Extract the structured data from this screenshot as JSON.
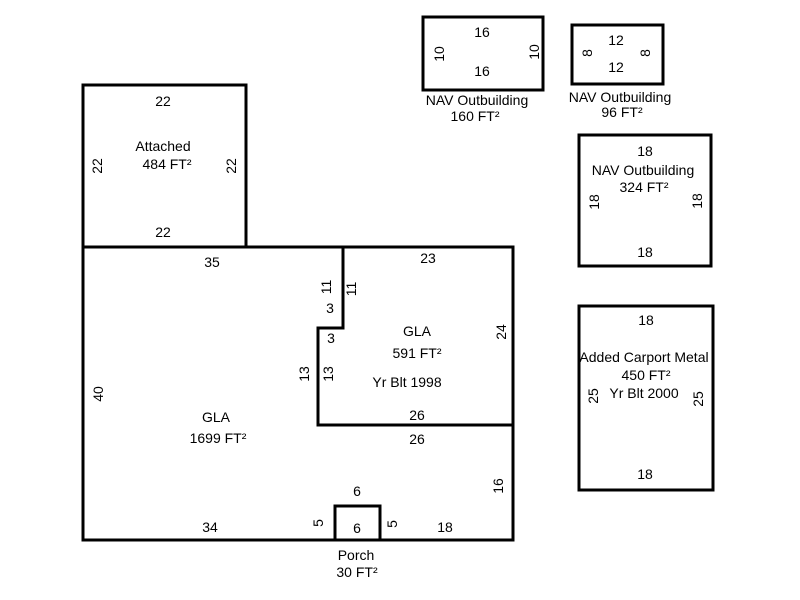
{
  "diagram": {
    "kind": "property-appraisal-sketch",
    "background": "#ffffff",
    "stroke": "#000000",
    "stroke_width": 3,
    "font_size_px": 14
  },
  "structures": [
    {
      "id": "attached-garage",
      "name": "Attached",
      "area": "484 FT²",
      "shapes": [
        {
          "name": "attached-garage-outline",
          "type": "rect",
          "x": 83,
          "y": 85,
          "w": 163,
          "h": 162
        }
      ],
      "labels": [
        {
          "role": "dim-top",
          "text": "22",
          "x": 163,
          "y": 101,
          "rot": 0
        },
        {
          "role": "name",
          "text": "Attached",
          "x": 163,
          "y": 146,
          "rot": 0
        },
        {
          "role": "area",
          "text": "484 FT²",
          "x": 167,
          "y": 164,
          "rot": 0
        },
        {
          "role": "dim-left",
          "text": "22",
          "x": 97,
          "y": 166,
          "rot": 1
        },
        {
          "role": "dim-right",
          "text": "22",
          "x": 231,
          "y": 166,
          "rot": 1
        },
        {
          "role": "dim-bottom",
          "text": "22",
          "x": 163,
          "y": 232,
          "rot": 0
        }
      ]
    },
    {
      "id": "main-dwelling",
      "name": "GLA",
      "area": "1699 FT²",
      "shapes": [
        {
          "name": "main-dwelling-outline",
          "type": "rect",
          "x": 83,
          "y": 247,
          "w": 430,
          "h": 293
        },
        {
          "name": "gla2-partition-wall",
          "type": "polyline",
          "points": [
            [
              343,
              247
            ],
            [
              343,
              328
            ],
            [
              318,
              328
            ],
            [
              318,
              425
            ],
            [
              513,
              425
            ]
          ]
        },
        {
          "name": "porch-outline",
          "type": "polyline",
          "points": [
            [
              335,
              540
            ],
            [
              335,
              506
            ],
            [
              380,
              506
            ],
            [
              380,
              540
            ]
          ]
        }
      ],
      "labels": [
        {
          "role": "dim-top-left",
          "text": "35",
          "x": 212,
          "y": 262,
          "rot": 0
        },
        {
          "role": "dim-top-right",
          "text": "23",
          "x": 428,
          "y": 258,
          "rot": 0
        },
        {
          "role": "dim-left",
          "text": "40",
          "x": 98,
          "y": 394,
          "rot": 1
        },
        {
          "role": "gla-name",
          "text": "GLA",
          "x": 216,
          "y": 417,
          "rot": 0
        },
        {
          "role": "gla-area",
          "text": "1699 FT²",
          "x": 218,
          "y": 438,
          "rot": 0
        },
        {
          "role": "partition-dim-11-outer",
          "text": "11",
          "x": 326,
          "y": 287,
          "rot": 1
        },
        {
          "role": "partition-dim-11-inner",
          "text": "11",
          "x": 351,
          "y": 289,
          "rot": 1
        },
        {
          "role": "partition-dim-3-upper",
          "text": "3",
          "x": 330,
          "y": 308,
          "rot": 0
        },
        {
          "role": "partition-dim-3-lower",
          "text": "3",
          "x": 331,
          "y": 338,
          "rot": 0
        },
        {
          "role": "partition-dim-13-outer",
          "text": "13",
          "x": 304,
          "y": 374,
          "rot": 1
        },
        {
          "role": "partition-dim-13-inner",
          "text": "13",
          "x": 328,
          "y": 374,
          "rot": 1
        },
        {
          "role": "gla2-name",
          "text": "GLA",
          "x": 417,
          "y": 331,
          "rot": 0
        },
        {
          "role": "gla2-area",
          "text": "591 FT²",
          "x": 417,
          "y": 353,
          "rot": 0
        },
        {
          "role": "gla2-year",
          "text": "Yr Blt 1998",
          "x": 407,
          "y": 382,
          "rot": 0
        },
        {
          "role": "dim-right-upper",
          "text": "24",
          "x": 501,
          "y": 332,
          "rot": 1
        },
        {
          "role": "partition-dim-26-inner",
          "text": "26",
          "x": 417,
          "y": 415,
          "rot": 0
        },
        {
          "role": "partition-dim-26-outer",
          "text": "26",
          "x": 417,
          "y": 439,
          "rot": 0
        },
        {
          "role": "dim-right-lower",
          "text": "16",
          "x": 498,
          "y": 486,
          "rot": 1
        },
        {
          "role": "dim-bottom-left",
          "text": "34",
          "x": 210,
          "y": 527,
          "rot": 0
        },
        {
          "role": "porch-dim-left",
          "text": "5",
          "x": 318,
          "y": 523,
          "rot": 1
        },
        {
          "role": "porch-dim-top",
          "text": "6",
          "x": 357,
          "y": 491,
          "rot": 0
        },
        {
          "role": "porch-dim-inner",
          "text": "6",
          "x": 357,
          "y": 528,
          "rot": 0
        },
        {
          "role": "porch-dim-right",
          "text": "5",
          "x": 392,
          "y": 524,
          "rot": 1
        },
        {
          "role": "dim-bottom-right",
          "text": "18",
          "x": 445,
          "y": 527,
          "rot": 0
        },
        {
          "role": "porch-name",
          "text": "Porch",
          "x": 356,
          "y": 555,
          "rot": 0
        },
        {
          "role": "porch-area",
          "text": "30 FT²",
          "x": 357,
          "y": 572,
          "rot": 0
        }
      ]
    },
    {
      "id": "nav-outbuilding-160",
      "name": "NAV Outbuilding",
      "area": "160 FT²",
      "shapes": [
        {
          "name": "nav-outbuilding-160-outline",
          "type": "rect",
          "x": 423,
          "y": 17,
          "w": 120,
          "h": 73
        }
      ],
      "labels": [
        {
          "role": "dim-top",
          "text": "16",
          "x": 482,
          "y": 32,
          "rot": 0
        },
        {
          "role": "dim-left",
          "text": "10",
          "x": 439,
          "y": 54,
          "rot": 1
        },
        {
          "role": "dim-right",
          "text": "10",
          "x": 534,
          "y": 52,
          "rot": 1
        },
        {
          "role": "dim-bottom",
          "text": "16",
          "x": 482,
          "y": 71,
          "rot": 0
        },
        {
          "role": "name",
          "text": "NAV Outbuilding",
          "x": 477,
          "y": 100,
          "rot": 0
        },
        {
          "role": "area",
          "text": "160 FT²",
          "x": 475,
          "y": 116,
          "rot": 0
        }
      ]
    },
    {
      "id": "nav-outbuilding-96",
      "name": "NAV Outbuilding",
      "area": "96 FT²",
      "shapes": [
        {
          "name": "nav-outbuilding-96-outline",
          "type": "rect",
          "x": 572,
          "y": 25,
          "w": 91,
          "h": 59
        }
      ],
      "labels": [
        {
          "role": "dim-top",
          "text": "12",
          "x": 616,
          "y": 40,
          "rot": 0
        },
        {
          "role": "dim-left",
          "text": "8",
          "x": 587,
          "y": 53,
          "rot": 1
        },
        {
          "role": "dim-right",
          "text": "8",
          "x": 645,
          "y": 53,
          "rot": 1
        },
        {
          "role": "dim-bottom",
          "text": "12",
          "x": 616,
          "y": 67,
          "rot": 0
        },
        {
          "role": "name",
          "text": "NAV Outbuilding",
          "x": 620,
          "y": 97,
          "rot": 0
        },
        {
          "role": "area",
          "text": "96 FT²",
          "x": 622,
          "y": 112,
          "rot": 0
        }
      ]
    },
    {
      "id": "nav-outbuilding-324",
      "name": "NAV Outbuilding",
      "area": "324 FT²",
      "shapes": [
        {
          "name": "nav-outbuilding-324-outline",
          "type": "rect",
          "x": 579,
          "y": 135,
          "w": 132,
          "h": 131
        }
      ],
      "labels": [
        {
          "role": "dim-top",
          "text": "18",
          "x": 645,
          "y": 151,
          "rot": 0
        },
        {
          "role": "name",
          "text": "NAV Outbuilding",
          "x": 643,
          "y": 170,
          "rot": 0
        },
        {
          "role": "area",
          "text": "324 FT²",
          "x": 644,
          "y": 187,
          "rot": 0
        },
        {
          "role": "dim-left",
          "text": "18",
          "x": 594,
          "y": 202,
          "rot": 1
        },
        {
          "role": "dim-right",
          "text": "18",
          "x": 697,
          "y": 201,
          "rot": 1
        },
        {
          "role": "dim-bottom",
          "text": "18",
          "x": 645,
          "y": 252,
          "rot": 0
        }
      ]
    },
    {
      "id": "added-carport-metal",
      "name": "Added Carport Metal",
      "area": "450 FT²",
      "year": "Yr Blt 2000",
      "shapes": [
        {
          "name": "added-carport-metal-outline",
          "type": "rect",
          "x": 579,
          "y": 306,
          "w": 134,
          "h": 184
        }
      ],
      "labels": [
        {
          "role": "dim-top",
          "text": "18",
          "x": 646,
          "y": 320,
          "rot": 0
        },
        {
          "role": "name",
          "text": "Added Carport Metal",
          "x": 644,
          "y": 357,
          "rot": 0
        },
        {
          "role": "area",
          "text": "450 FT²",
          "x": 646,
          "y": 375,
          "rot": 0
        },
        {
          "role": "year",
          "text": "Yr Blt 2000",
          "x": 644,
          "y": 393,
          "rot": 0
        },
        {
          "role": "dim-left",
          "text": "25",
          "x": 593,
          "y": 396,
          "rot": 1
        },
        {
          "role": "dim-right",
          "text": "25",
          "x": 698,
          "y": 399,
          "rot": 1
        },
        {
          "role": "dim-bottom",
          "text": "18",
          "x": 645,
          "y": 474,
          "rot": 0
        }
      ]
    }
  ]
}
